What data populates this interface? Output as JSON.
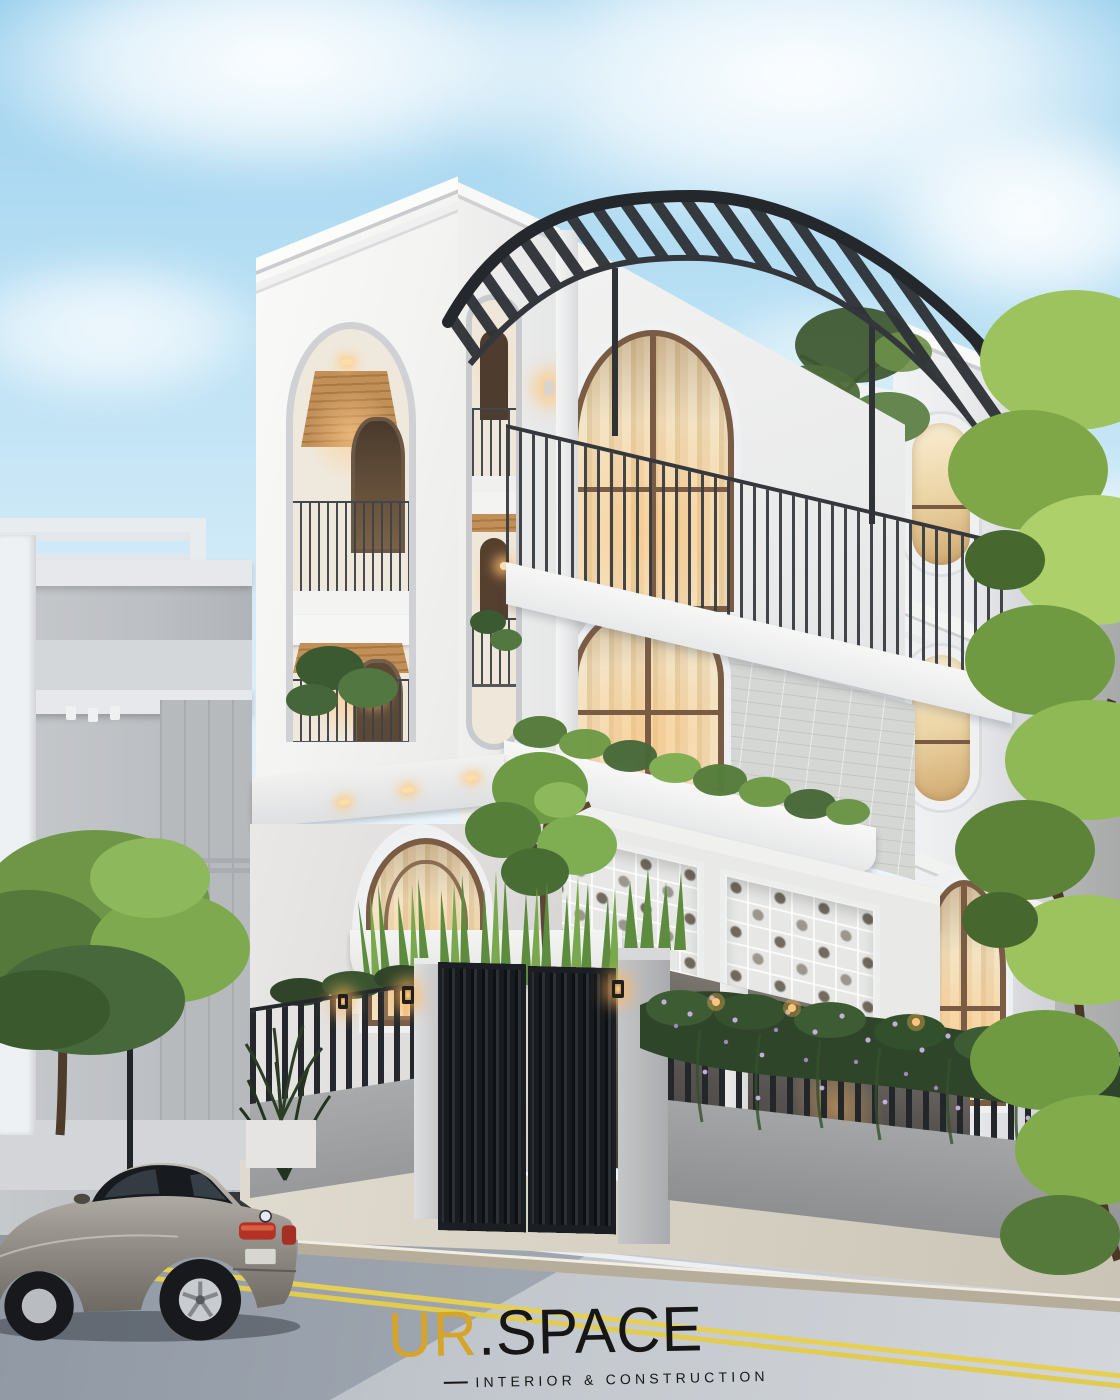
{
  "watermark": {
    "brand_primary": "UR",
    "brand_secondary": ".SPACE",
    "tagline": "INTERIOR & CONSTRUCTION"
  },
  "palette": {
    "brand_gold": "#D7A42A",
    "brand_ink": "#161616",
    "sky_top": "#9FD2EE",
    "sky_horizon": "#EEF6FB",
    "facade_white": "#F6F5F3",
    "facade_shade": "#E4E6E8",
    "stone_tile": "#D4D6D3",
    "iron_dark": "#2E3236",
    "wood_ceiling": "#B9854E",
    "warm_light": "#FFD9A0",
    "foliage": "#7FA94C",
    "flower_purple": "#C9B3E6",
    "street": "#C3C8CE",
    "sidewalk": "#D8D2C4",
    "lane_yellow": "#E6D054",
    "car_body": "#9A968F"
  },
  "scene": {
    "objects": [
      "sky",
      "clouds",
      "neighbor-building-left",
      "street-lamp",
      "tree-left",
      "main-villa",
      "curved-pergola",
      "roof-terrace",
      "capsule-window",
      "arched-balconies",
      "breeze-block-screens",
      "right-tower",
      "oval-windows",
      "entry-gate",
      "gate-lanterns",
      "perimeter-fence",
      "vine-hedge",
      "tree-right",
      "sidewalk",
      "street",
      "sedan-car",
      "watermark-logo"
    ]
  }
}
